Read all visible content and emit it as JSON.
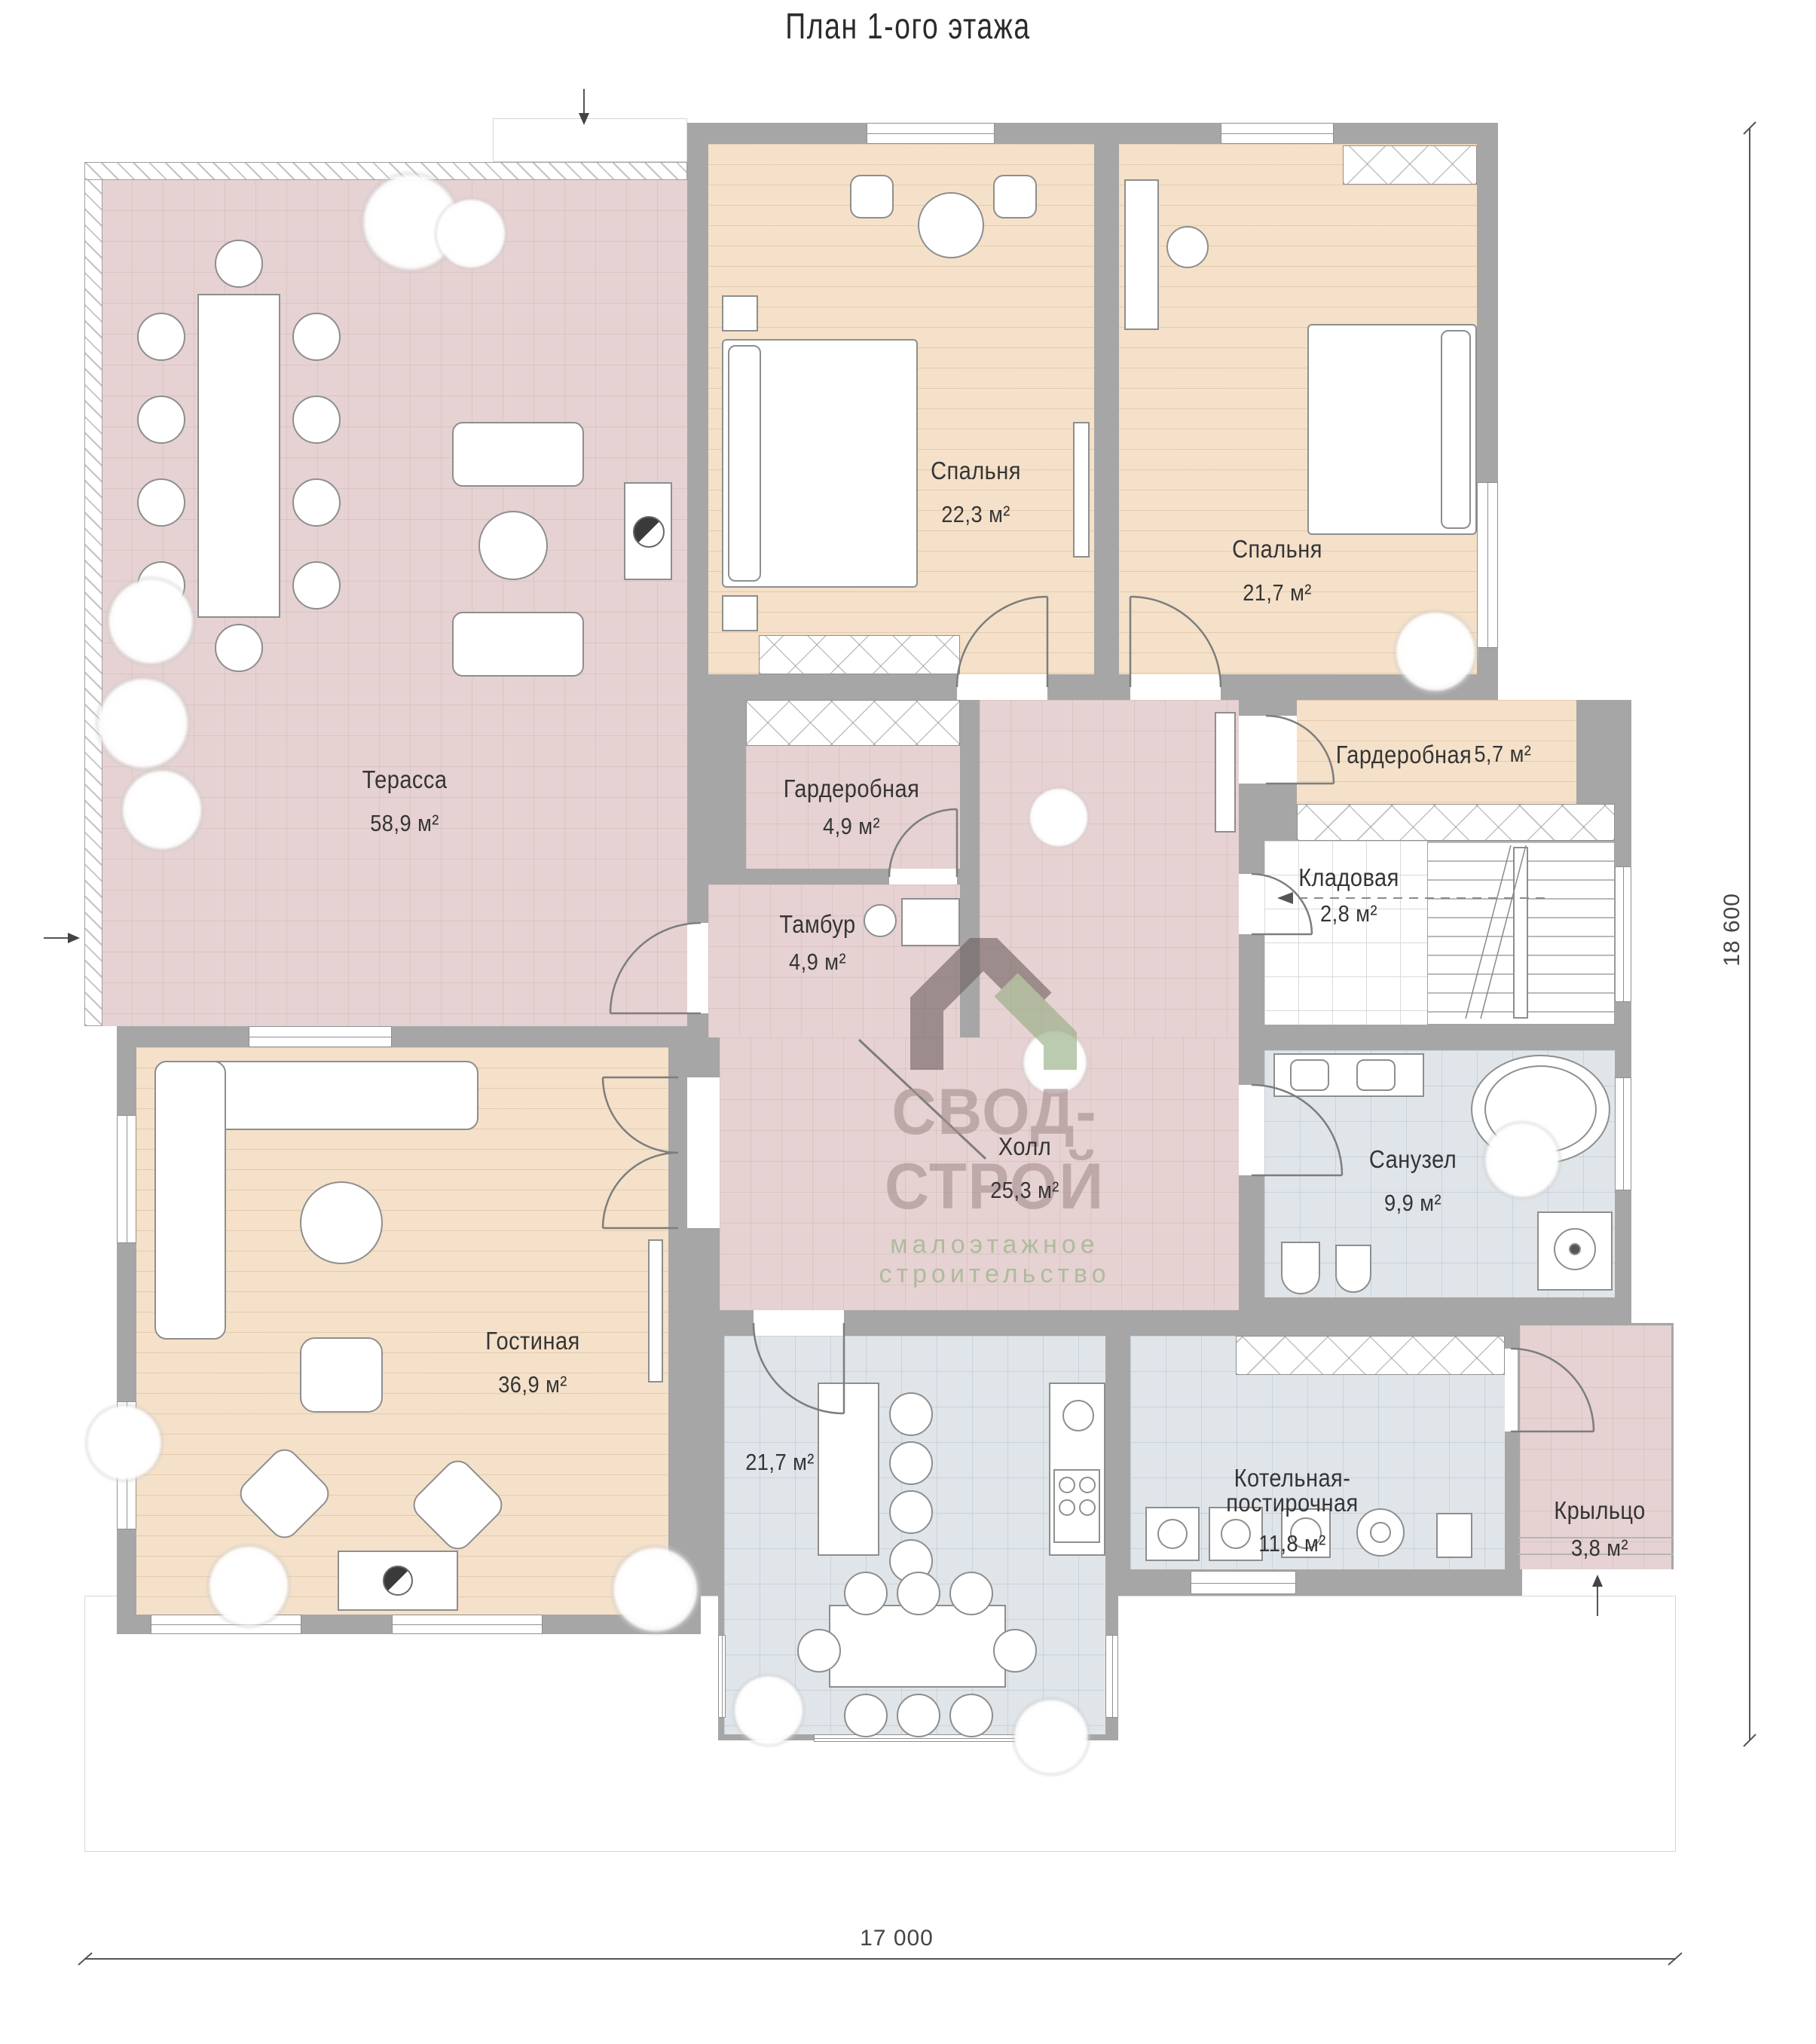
{
  "title": "План 1-ого этажа",
  "rooms": [
    {
      "name": "Терасса",
      "area": "58,9 м²"
    },
    {
      "name": "Спальня",
      "area": "22,3 м²"
    },
    {
      "name": "Спальня",
      "area": "21,7 м²"
    },
    {
      "name": "Гардеробная",
      "area": "4,9 м²"
    },
    {
      "name": "Тамбур",
      "area": "4,9 м²"
    },
    {
      "name": "Гардеробная",
      "area": "5,7 м²"
    },
    {
      "name": "Кладовая",
      "area": "2,8 м²"
    },
    {
      "name": "Холл",
      "area": "25,3 м²"
    },
    {
      "name": "Санузел",
      "area": "9,9 м²"
    },
    {
      "name": "Гостиная",
      "area": "36,9 м²"
    },
    {
      "name": "",
      "area": "21,7 м²"
    },
    {
      "name": "Котельная-постирочная",
      "area": "11,8 м²"
    },
    {
      "name": "Крыльцо",
      "area": "3,8 м²"
    }
  ],
  "dimensions": {
    "width": "17 000",
    "height": "18 600"
  },
  "logo": {
    "name": "СВОД-СТРОЙ",
    "subtitle": "малоэтажное строительство"
  },
  "colors": {
    "wall": "#a6a6a6",
    "terrace_floor": "#e6d2d2",
    "wood_floor": "#f5e1c9",
    "tile_floor": "#e0e5e9",
    "logo_text": "#a78f8f",
    "logo_green": "#8fae7e"
  }
}
